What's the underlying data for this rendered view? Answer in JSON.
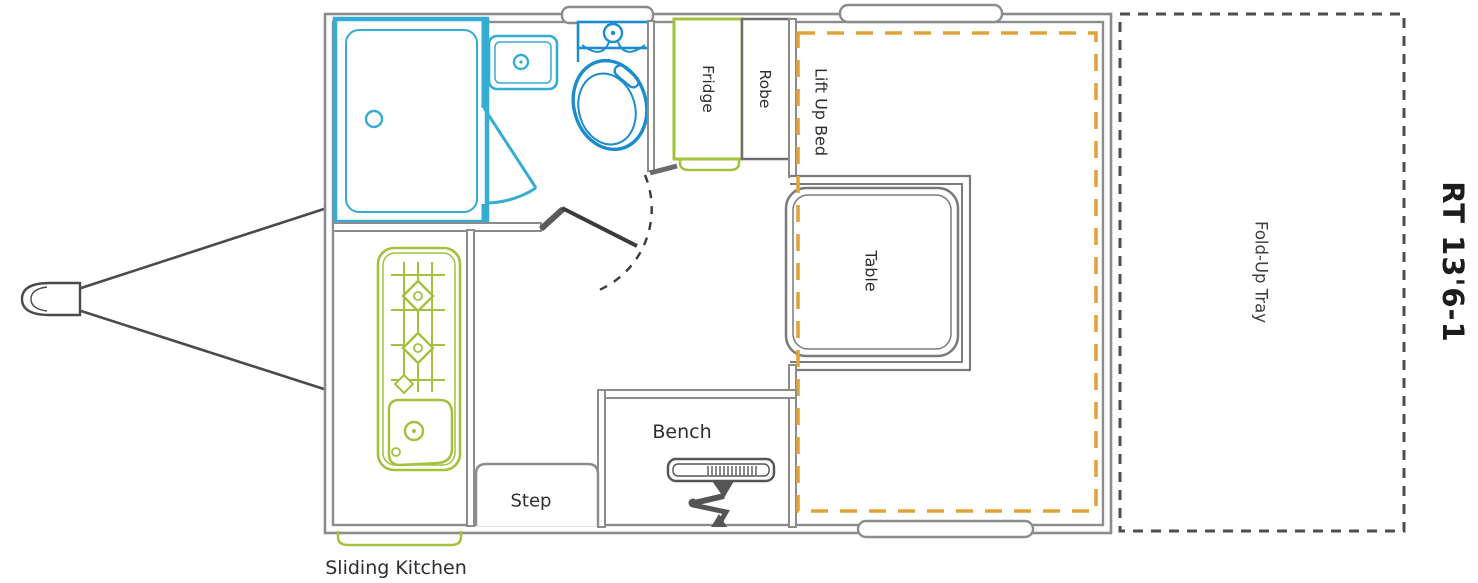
{
  "title": "Caravan floor plan",
  "model_label": "RT 13'6-1",
  "labels": {
    "fridge": "Fridge",
    "robe": "Robe",
    "lift_up_bed": "Lift Up Bed",
    "table": "Table",
    "bench": "Bench",
    "step": "Step",
    "sliding_kitchen": "Sliding Kitchen",
    "fold_up_tray": "Fold-Up Tray"
  },
  "colors": {
    "fixture_cyan": "#35acd3",
    "toilet_blue": "#1d8cce",
    "kitchen_green": "#a2c13d",
    "bed_orange": "#e3a33c",
    "wall_gray": "#8c8c8c",
    "dark_gray": "#5a5a5a",
    "door_dark": "#3b3b3b",
    "tray_dash": "#4e4e4e",
    "text": "#2e2e2e"
  }
}
